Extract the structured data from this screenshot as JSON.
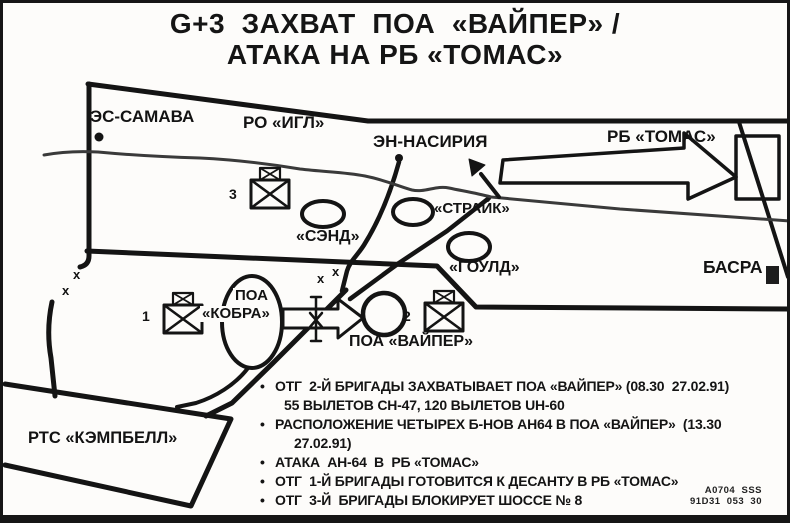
{
  "page": {
    "background": "#fdfcfa",
    "ink": "#141414"
  },
  "title": {
    "line1": "G+3  ЗАХВАТ  ПОА  «ВАЙПЕР» /",
    "line2": "АТАКА НА РБ «ТОМАС»"
  },
  "map": {
    "places": {
      "es_samava": "ЭС-САМАВА",
      "ro_igl": "РО «ИГЛ»",
      "en_nasiriya": "ЭН-НАСИРИЯ",
      "rb_tomas": "РБ «ТОМАС»",
      "strike": "«СТРАЙК»",
      "sand": "«СЭНД»",
      "gould": "«ГОУЛД»",
      "basra": "БАСРА",
      "poa_word": "ПОА",
      "cobra": "«КОБРА»",
      "poa_viper": "ПОА «ВАЙПЕР»",
      "rts_campbell": "РТС «КЭМПБЕЛЛ»"
    },
    "unit_numbers": {
      "first": "1",
      "second": "2",
      "third": "3"
    },
    "x_mark": "x"
  },
  "notes": {
    "items": [
      {
        "text": "ОТГ  2-Й БРИГАДЫ ЗАХВАТЫВАЕТ ПОА «ВАЙПЕР» (08.30  27.02.91)"
      },
      {
        "text": "55 ВЫЛЕТОВ CH-47, 120 ВЫЛЕТОВ UH-60"
      },
      {
        "text": "РАСПОЛОЖЕНИЕ ЧЕТЫРЕХ Б-НОВ AH64 В ПОА «ВАЙПЕР»  (13.30"
      },
      {
        "text": "27.02.91)"
      },
      {
        "text": "АТАКА  AH-64  В  РБ «ТОМАС»"
      },
      {
        "text": "ОТГ  1-Й БРИГАДЫ ГОТОВИТСЯ К ДЕСАНТУ В РБ «ТОМАС»"
      },
      {
        "text": "ОТГ  3-Й  БРИГАДЫ БЛОКИРУЕТ ШОССЕ № 8"
      }
    ]
  },
  "stamp": {
    "line1": "A0704  SSS",
    "line2": "91D31  053  30"
  }
}
